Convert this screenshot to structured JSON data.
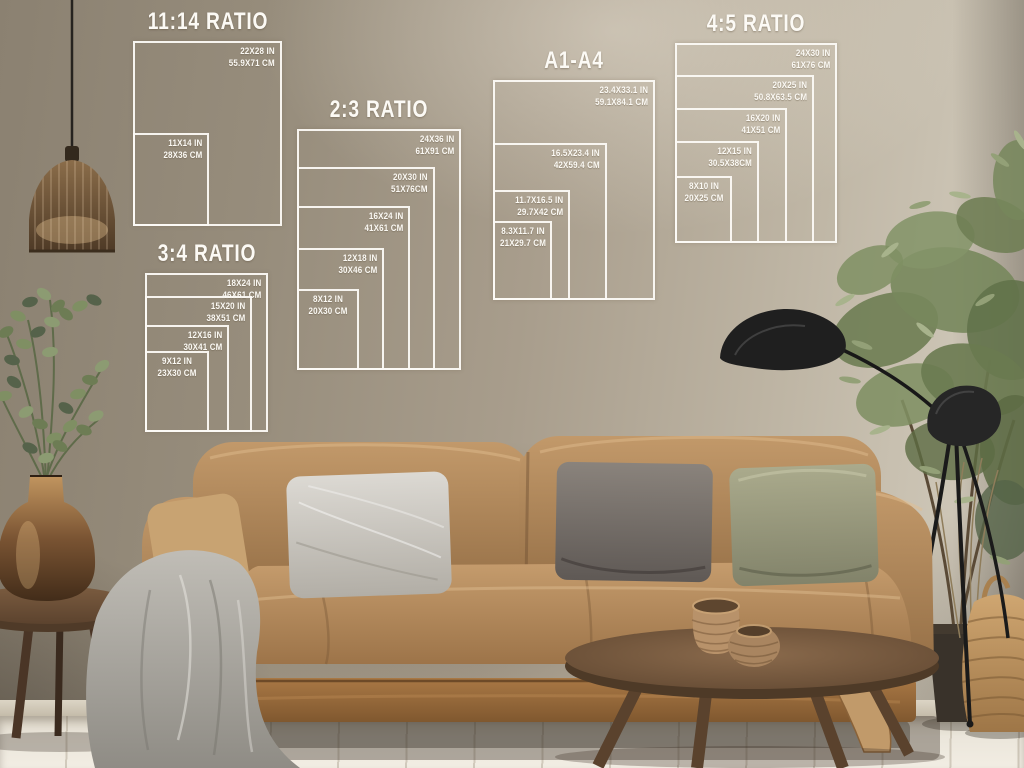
{
  "guides": {
    "r1114": {
      "title": "11:14 RATIO",
      "sizes": [
        {
          "in": "22X28 IN",
          "cm": "55.9X71 CM"
        },
        {
          "in": "11X14 IN",
          "cm": "28X36 CM"
        }
      ]
    },
    "r23": {
      "title": "2:3 RATIO",
      "sizes": [
        {
          "in": "24X36 IN",
          "cm": "61X91 CM"
        },
        {
          "in": "20X30 IN",
          "cm": "51X76CM"
        },
        {
          "in": "16X24 IN",
          "cm": "41X61 CM"
        },
        {
          "in": "12X18 IN",
          "cm": "30X46 CM"
        },
        {
          "in": "8X12 IN",
          "cm": "20X30 CM"
        }
      ]
    },
    "a14": {
      "title": "A1-A4",
      "sizes": [
        {
          "in": "23.4X33.1 IN",
          "cm": "59.1X84.1 CM"
        },
        {
          "in": "16.5X23.4 IN",
          "cm": "42X59.4 CM"
        },
        {
          "in": "11.7X16.5 IN",
          "cm": "29.7X42 CM"
        },
        {
          "in": "8.3X11.7 IN",
          "cm": "21X29.7 CM"
        }
      ]
    },
    "r45": {
      "title": "4:5 RATIO",
      "sizes": [
        {
          "in": "24X30 IN",
          "cm": "61X76 CM"
        },
        {
          "in": "20X25 IN",
          "cm": "50.8X63.5 CM"
        },
        {
          "in": "16X20 IN",
          "cm": "41X51 CM"
        },
        {
          "in": "12X15 IN",
          "cm": "30.5X38CM"
        },
        {
          "in": "8X10 IN",
          "cm": "20X25 CM"
        }
      ]
    },
    "r34": {
      "title": "3:4 RATIO",
      "sizes": [
        {
          "in": "18X24 IN",
          "cm": "46X61 CM"
        },
        {
          "in": "15X20 IN",
          "cm": "38X51 CM"
        },
        {
          "in": "12X16 IN",
          "cm": "30X41 CM"
        },
        {
          "in": "9X12 IN",
          "cm": "23X30 CM"
        }
      ]
    }
  },
  "colors": {
    "guide_line": "#fcfaf5",
    "wall_light": "#d2cbbc",
    "wall_mid": "#a89d8c",
    "wall_dark": "#57504a",
    "floor": "#ebe6db",
    "sofa_tan": "#b68c5e",
    "pillow_silver": "#cfccc5",
    "pillow_gray": "#7b7370",
    "pillow_olive": "#9fa083",
    "throw_gray": "#aaa79f",
    "wood_dark": "#5d4430",
    "bronze": "#8a6540",
    "lamp_black": "#1f1f1f",
    "plant_green": "#6e7d53"
  }
}
